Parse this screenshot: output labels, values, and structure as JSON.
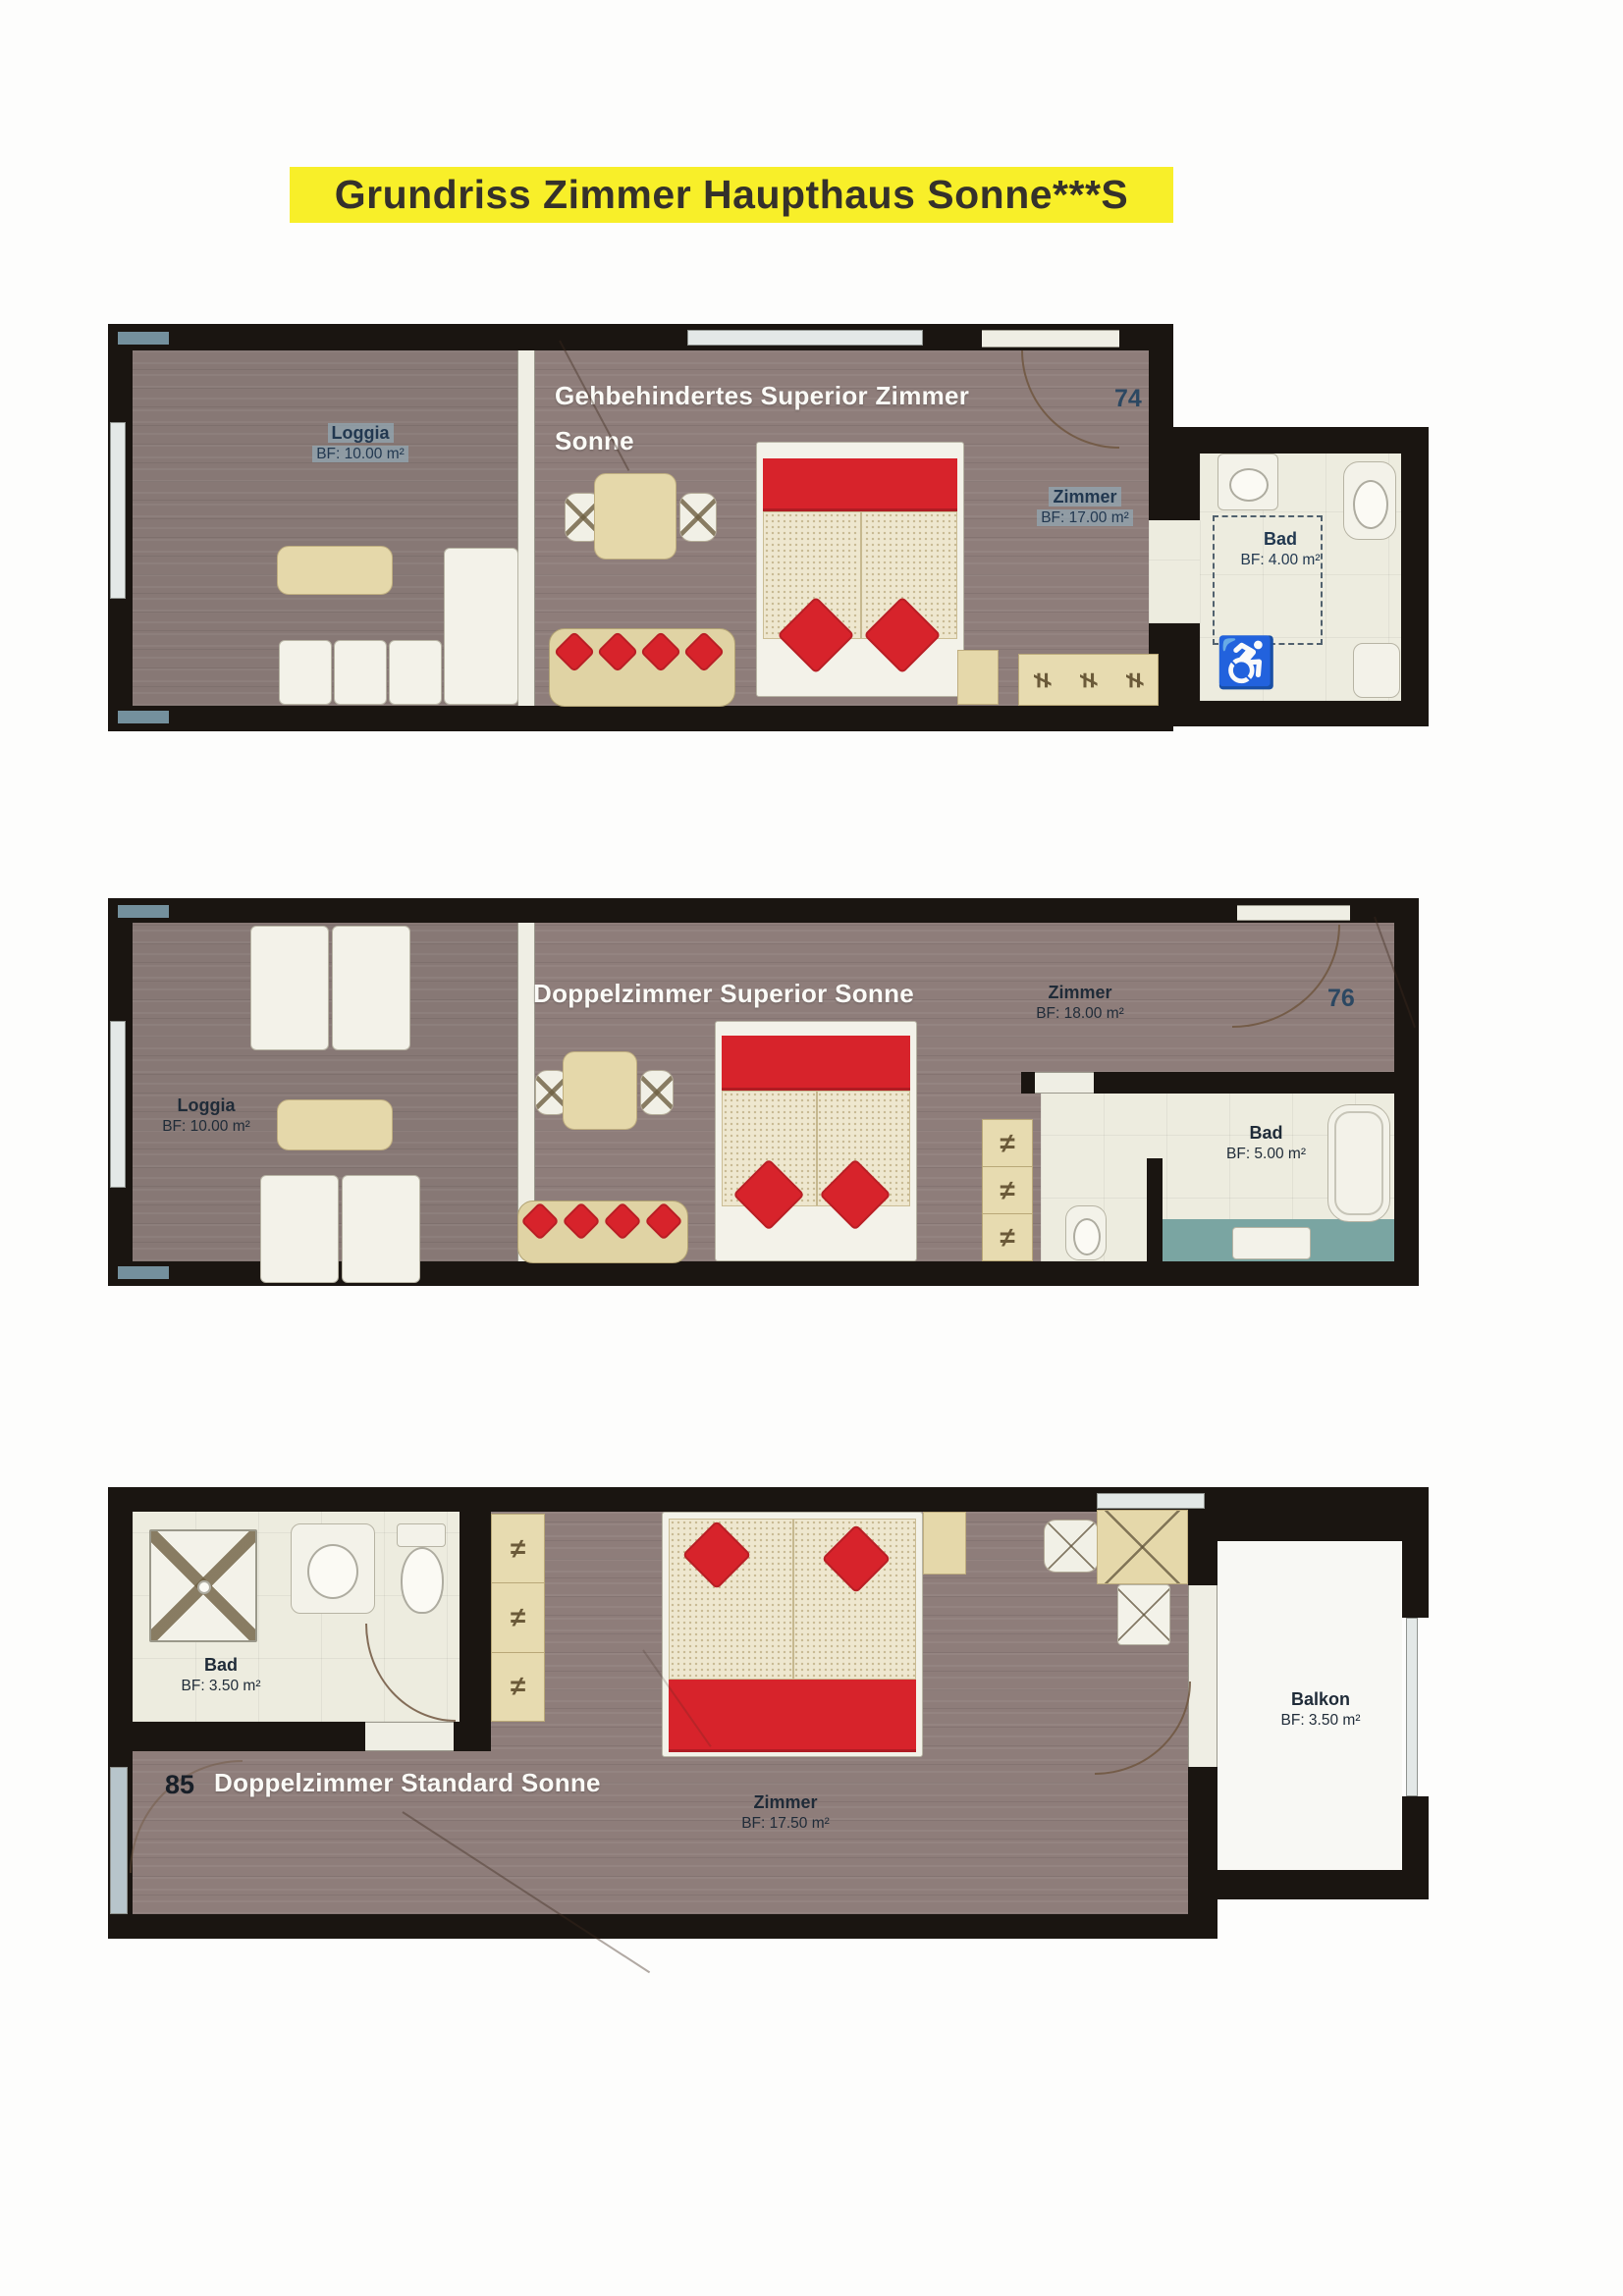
{
  "title": "Grundriss Zimmer Haupthaus Sonne***S",
  "plans": [
    {
      "room_number": "74",
      "name_line1": "Gehbehindertes Superior Zimmer",
      "name_line2": "Sonne",
      "loggia_label": "Loggia",
      "loggia_area": "BF: 10.00 m²",
      "zimmer_label": "Zimmer",
      "zimmer_area": "BF: 17.00 m²",
      "bad_label": "Bad",
      "bad_area": "BF: 4.00 m²"
    },
    {
      "room_number": "76",
      "name": "Doppelzimmer Superior Sonne",
      "loggia_label": "Loggia",
      "loggia_area": "BF: 10.00 m²",
      "zimmer_label": "Zimmer",
      "zimmer_area": "BF: 18.00 m²",
      "bad_label": "Bad",
      "bad_area": "BF: 5.00 m²"
    },
    {
      "room_number": "85",
      "name": "Doppelzimmer Standard Sonne",
      "bad_label": "Bad",
      "bad_area": "BF: 3.50 m²",
      "zimmer_label": "Zimmer",
      "zimmer_area": "BF: 17.50 m²",
      "balkon_label": "Balkon",
      "balkon_area": "BF: 3.50 m²"
    }
  ],
  "icons": {
    "wheelchair": "♿",
    "hanger": "≠"
  }
}
